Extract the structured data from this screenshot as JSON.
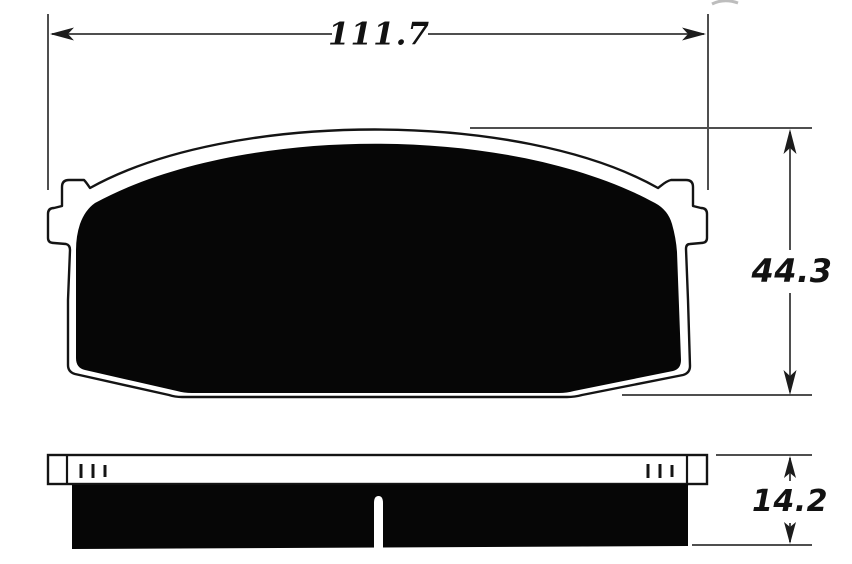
{
  "page": {
    "type": "technical-drawing",
    "subject": "brake-pad",
    "background_color": "#ffffff"
  },
  "drawing": {
    "dimensions": {
      "overall_width": "111.7",
      "overall_height": "44.3",
      "thickness": "14.2"
    },
    "colors": {
      "outline": "#141414",
      "friction_fill": "#060606",
      "dimension_line": "#4f4f4f",
      "arrowhead": "#1c1c1c"
    }
  }
}
